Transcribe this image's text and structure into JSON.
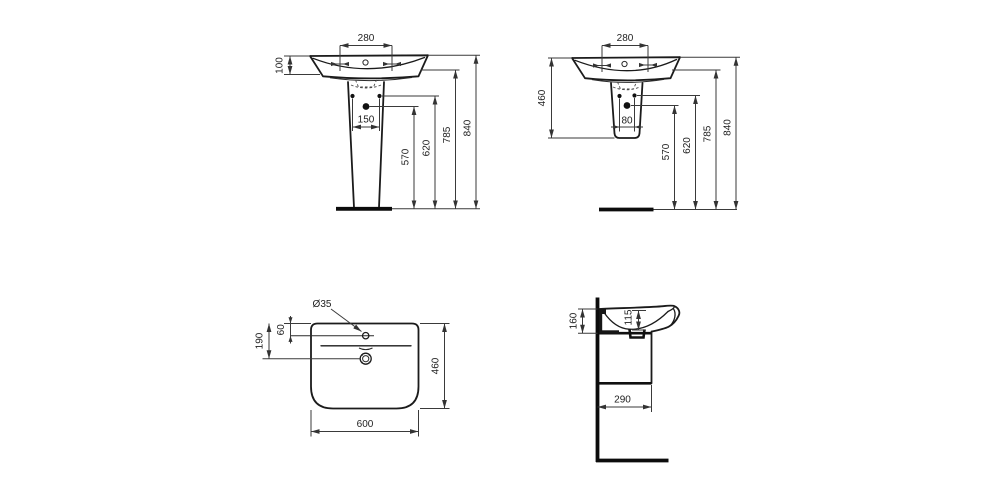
{
  "document": {
    "type": "sanitary-ware dimension drawing",
    "units": "mm",
    "colors": {
      "background": "#ffffff",
      "outline": "#1b1b1b",
      "dimension": "#3a3a3a",
      "text": "#1e1e1e"
    }
  },
  "views": {
    "front_with_pedestal": {
      "name": "washbasin front view with full pedestal",
      "dims": {
        "taphole_spacing": "280",
        "basin_rim_depth": "100",
        "pedestal_fixing_spacing": "150",
        "trap_outlet_height": "570",
        "fixing_holes_height": "620",
        "basin_underside_height": "785",
        "rim_total_height": "840"
      }
    },
    "front_with_semipedestal": {
      "name": "washbasin front view with semi-pedestal",
      "dims": {
        "taphole_spacing": "280",
        "semipedestal_height": "460",
        "fixing_spacing": "80",
        "trap_outlet_height": "570",
        "fixing_holes_height": "620",
        "basin_underside_height": "785",
        "rim_total_height": "840"
      }
    },
    "plan": {
      "name": "washbasin plan view",
      "dims": {
        "taphole_diameter": "Ø35",
        "taphole_offset_from_back": "60",
        "drain_offset_from_back": "190",
        "overall_width": "600",
        "overall_depth": "460"
      }
    },
    "side": {
      "name": "washbasin side section view",
      "dims": {
        "rim_to_underside": "160",
        "bowl_depth": "115",
        "projection_depth": "290"
      }
    }
  }
}
